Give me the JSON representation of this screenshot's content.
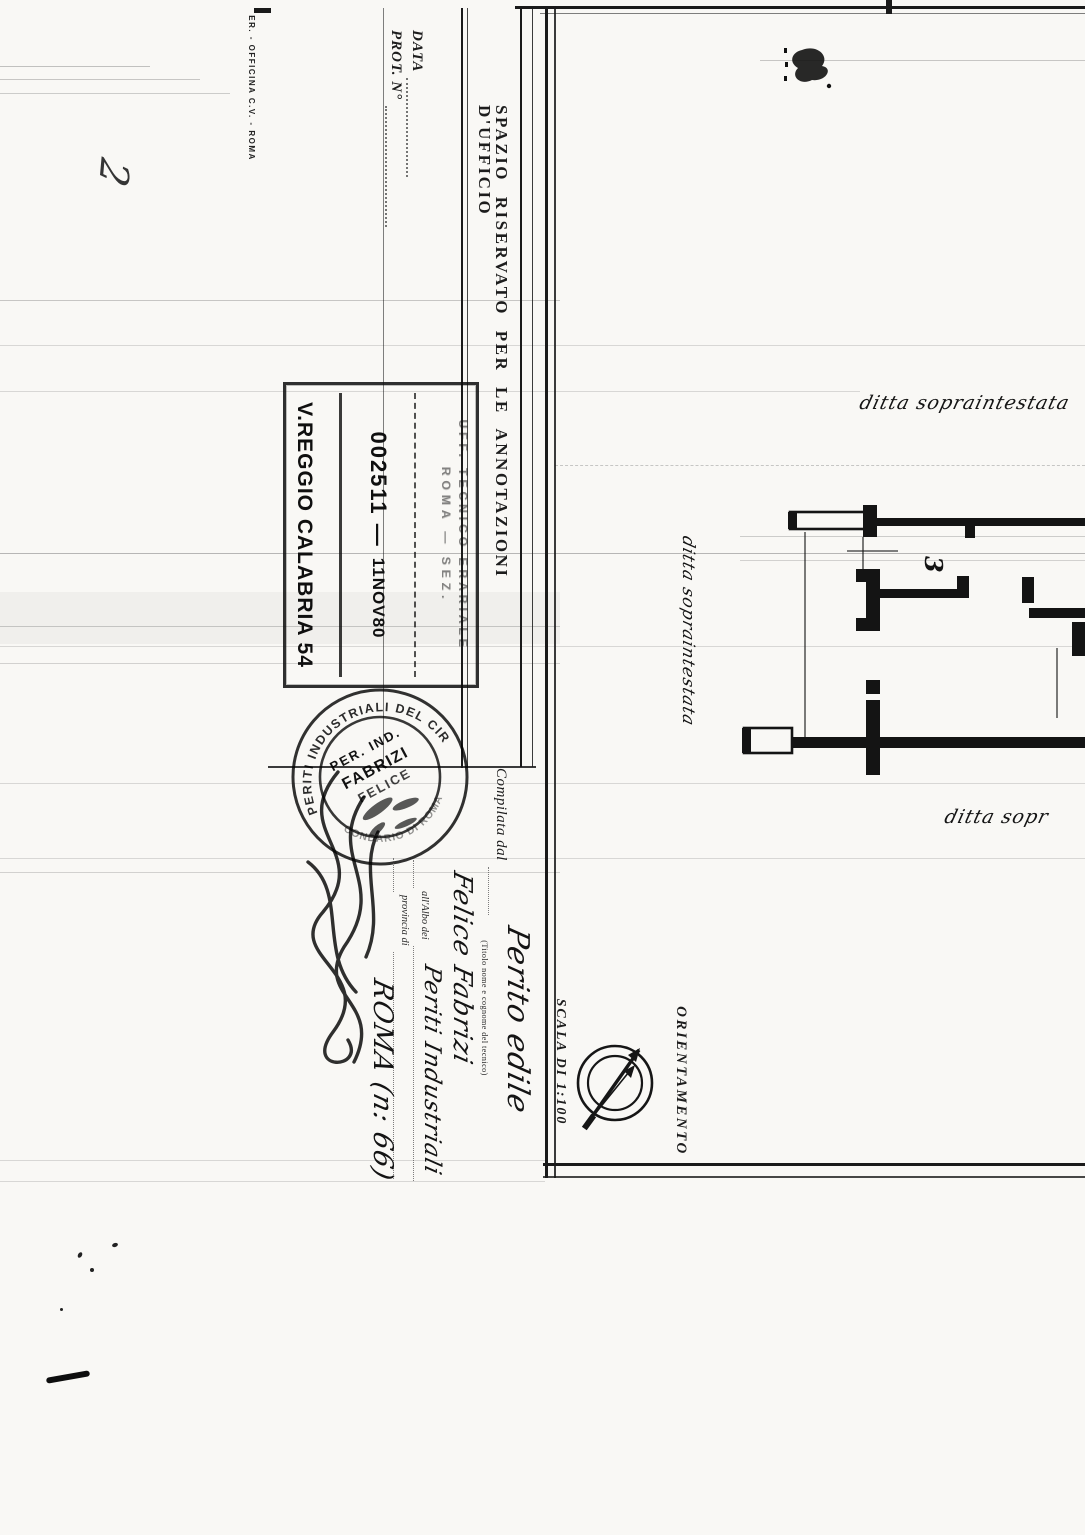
{
  "document": {
    "printer_mark": "ER. - OFFICINA C.V. - ROMA",
    "handwritten_note_top": "2",
    "office_section": {
      "title": "SPAZIO RISERVATO PER LE ANNOTAZIONI D'UFFICIO",
      "date_label": "DATA",
      "protocol_label": "PROT. N°"
    },
    "registry_stamp": {
      "office_line1": "UFF. TECNICO ERARIALE",
      "office_line2": "ROMA — SEZ.",
      "protocol_number": "002511 —",
      "date": "11NOV80",
      "city_line": "V.REGGIO CALABRIA 54"
    },
    "professional_stamp": {
      "ring_top": "PERITI INDUSTRIALI DEL CIR",
      "ring_bottom": "CONDARIO DI ROMA",
      "inner_title": "PER. IND.",
      "inner_surname": "FABRIZI",
      "inner_name": "FELICE"
    },
    "compiled_by": {
      "label": "Compilata dal",
      "sublabel": "(Titolo nome e cognome del tecnico)",
      "qualification": "Perito edile",
      "technician_name": "Felice Fabrizi",
      "register_label": "all'Albo dei",
      "register_value": "Periti Industriali",
      "province_label": "provincia di",
      "province_value": "ROMA (n: 66)"
    },
    "plan": {
      "scale_label": "SCALA DI 1:100",
      "orientation_label": "ORIENTAMENTO",
      "room_number": "3",
      "annotation_top": "ditta sopraintestata",
      "annotation_side": "ditta sopraintestata",
      "annotation_bottom_right": "ditta sopr"
    }
  },
  "colors": {
    "ink": "#1a1a1a",
    "stamp_ink": "#101010",
    "faint_line": "#8a8a8a",
    "paper": "#f9f8f5"
  }
}
